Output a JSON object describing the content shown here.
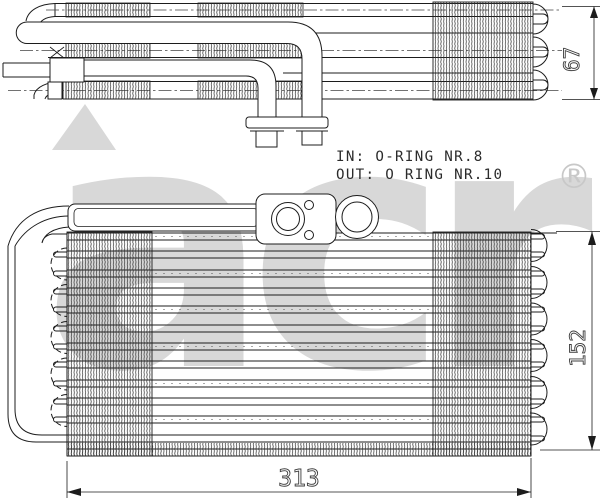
{
  "page": {
    "background": "#ffffff"
  },
  "drawing": {
    "type": "technical-line-drawing",
    "subject": "A/C evaporator, two orthographic views",
    "line_color": "#1c1c1c",
    "labels": {
      "in": "IN: O-RING NR.8",
      "out": "OUT: O RING NR.10"
    },
    "dimensions": {
      "depth": "67",
      "height": "152",
      "width": "313"
    },
    "watermark": {
      "brand": "acr",
      "registered_mark": "®",
      "color": "#d8d8d8"
    }
  }
}
